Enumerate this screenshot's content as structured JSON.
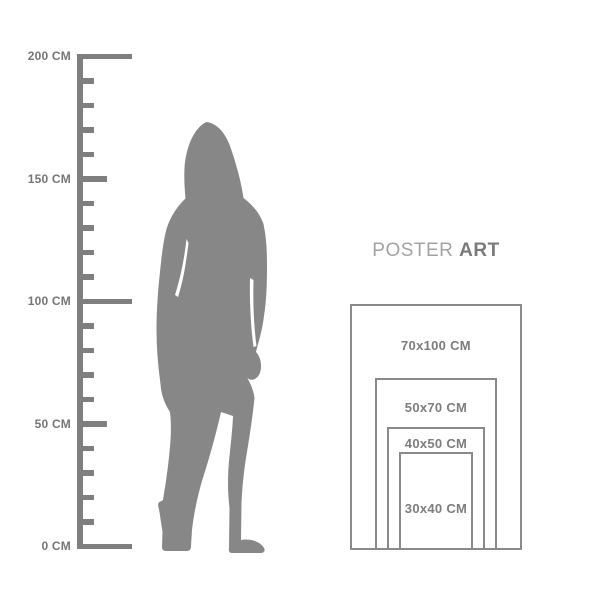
{
  "ruler": {
    "unit": "CM",
    "max_cm": 200,
    "tick_interval_cm": 10,
    "px_per_cm": 2.45,
    "color": "#7f7f7f",
    "labels": [
      {
        "value": 200,
        "text": "200 CM"
      },
      {
        "value": 150,
        "text": "150 CM"
      },
      {
        "value": 100,
        "text": "100 CM"
      },
      {
        "value": 50,
        "text": "50 CM"
      },
      {
        "value": 0,
        "text": "0 CM"
      }
    ]
  },
  "figure": {
    "description": "standing-woman-silhouette",
    "color": "#878787"
  },
  "title": {
    "word1": "POSTER",
    "word2": "ART"
  },
  "posters": {
    "border_color": "#8a8a8a",
    "sizes": [
      {
        "label": "70x100 CM",
        "w_cm": 70,
        "h_cm": 100
      },
      {
        "label": "50x70 CM",
        "w_cm": 50,
        "h_cm": 70
      },
      {
        "label": "40x50 CM",
        "w_cm": 40,
        "h_cm": 50
      },
      {
        "label": "30x40 CM",
        "w_cm": 30,
        "h_cm": 40
      }
    ]
  }
}
